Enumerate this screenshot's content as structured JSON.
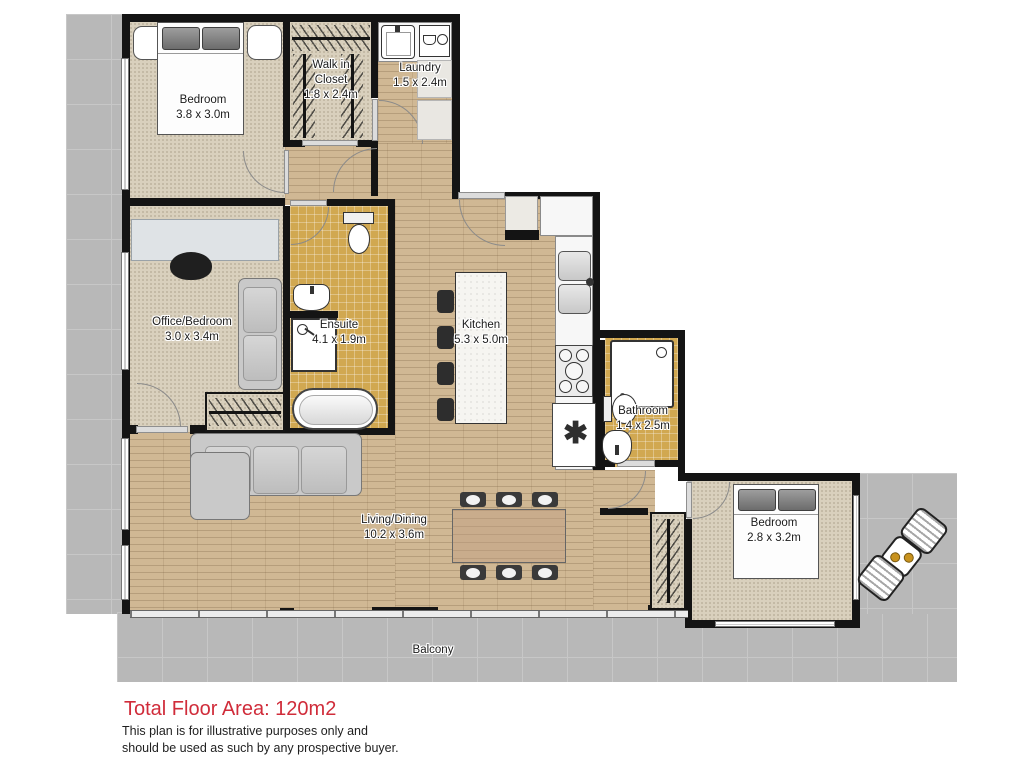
{
  "plan": {
    "rooms": [
      {
        "name": "Bedroom",
        "dims": "3.8 x 3.0m"
      },
      {
        "name": "Walk in Closet",
        "dims": "1:8 x 2.4m"
      },
      {
        "name": "Laundry",
        "dims": "1.5 x 2.4m"
      },
      {
        "name": "Office/Bedroom",
        "dims": "3.0 x 3.4m"
      },
      {
        "name": "Ensuite",
        "dims": "4.1 x 1.9m"
      },
      {
        "name": "Kitchen",
        "dims": "5.3 x 5.0m"
      },
      {
        "name": "Bathroom",
        "dims": "1.4 x 2.5m"
      },
      {
        "name": "Living/Dining",
        "dims": "10.2 x 3.6m"
      },
      {
        "name": "Bedroom",
        "dims": "2.8 x 3.2m"
      }
    ],
    "outdoor_label": "Balcony"
  },
  "footer": {
    "total_area": "Total Floor Area: 120m2",
    "disclaimer_line1": "This plan is for illustrative purposes only and",
    "disclaimer_line2": "should be used as such by any prospective buyer."
  },
  "colors": {
    "accent_red": "#d02c3a",
    "wall_black": "#141414",
    "carpet_beige": "#d9d0bd",
    "wood_tan": "#d0b894",
    "tile_gold": "#d1a851",
    "outdoor_gray": "#b8b8b8"
  }
}
